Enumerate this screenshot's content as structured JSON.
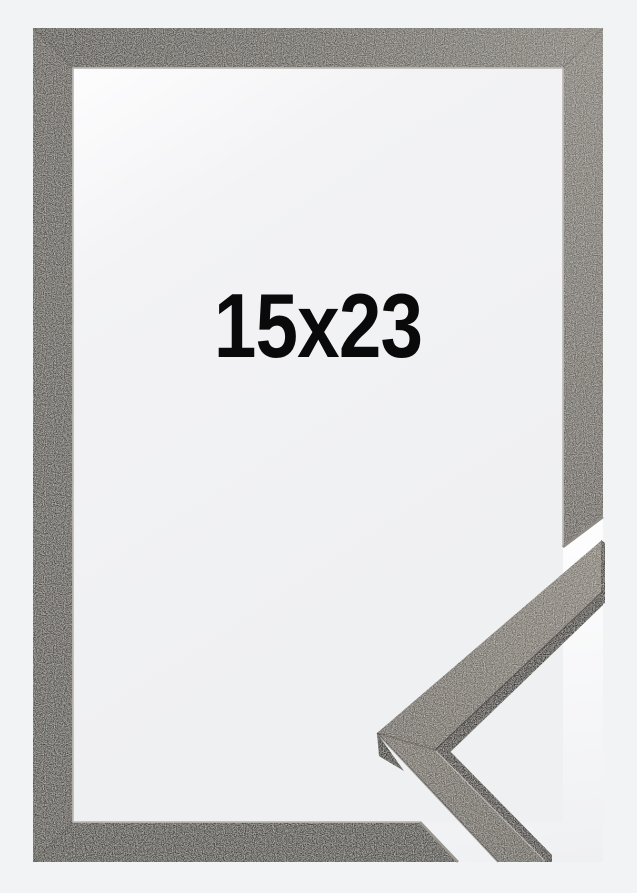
{
  "label": {
    "text": "15x23",
    "color": "#0a0a0a"
  },
  "colors": {
    "page_background": "#f2f3f4",
    "interior_top": "#fdfdfe",
    "interior_mid": "#f3f3f5",
    "interior_bottom": "#eff0f2",
    "cut_gap_white": "#fdfdfe",
    "frame_face_dark": "#5a5651",
    "frame_face_mid": "#6f6a64",
    "frame_face_light": "#8b867f",
    "frame_right_end": "#6d6761",
    "frame_left_top": "#67625d",
    "frame_left_bottom": "#5a5651",
    "frame_bottom_bar": "#534f4b",
    "frame_inner_lip": "#bcb9b5",
    "cut_edge_right": "#908c86",
    "cut_edge_bottom": "#9a958f",
    "profile_face_light": "#8e887f",
    "profile_face_dark": "#746e67",
    "profile_lower_light": "#7b756d",
    "profile_lower_dark": "#6f6962",
    "profile_side_shadow": "#45413c",
    "profile_tip_shadow": "#3e3a36",
    "profile_end_face": "#4a4540"
  }
}
